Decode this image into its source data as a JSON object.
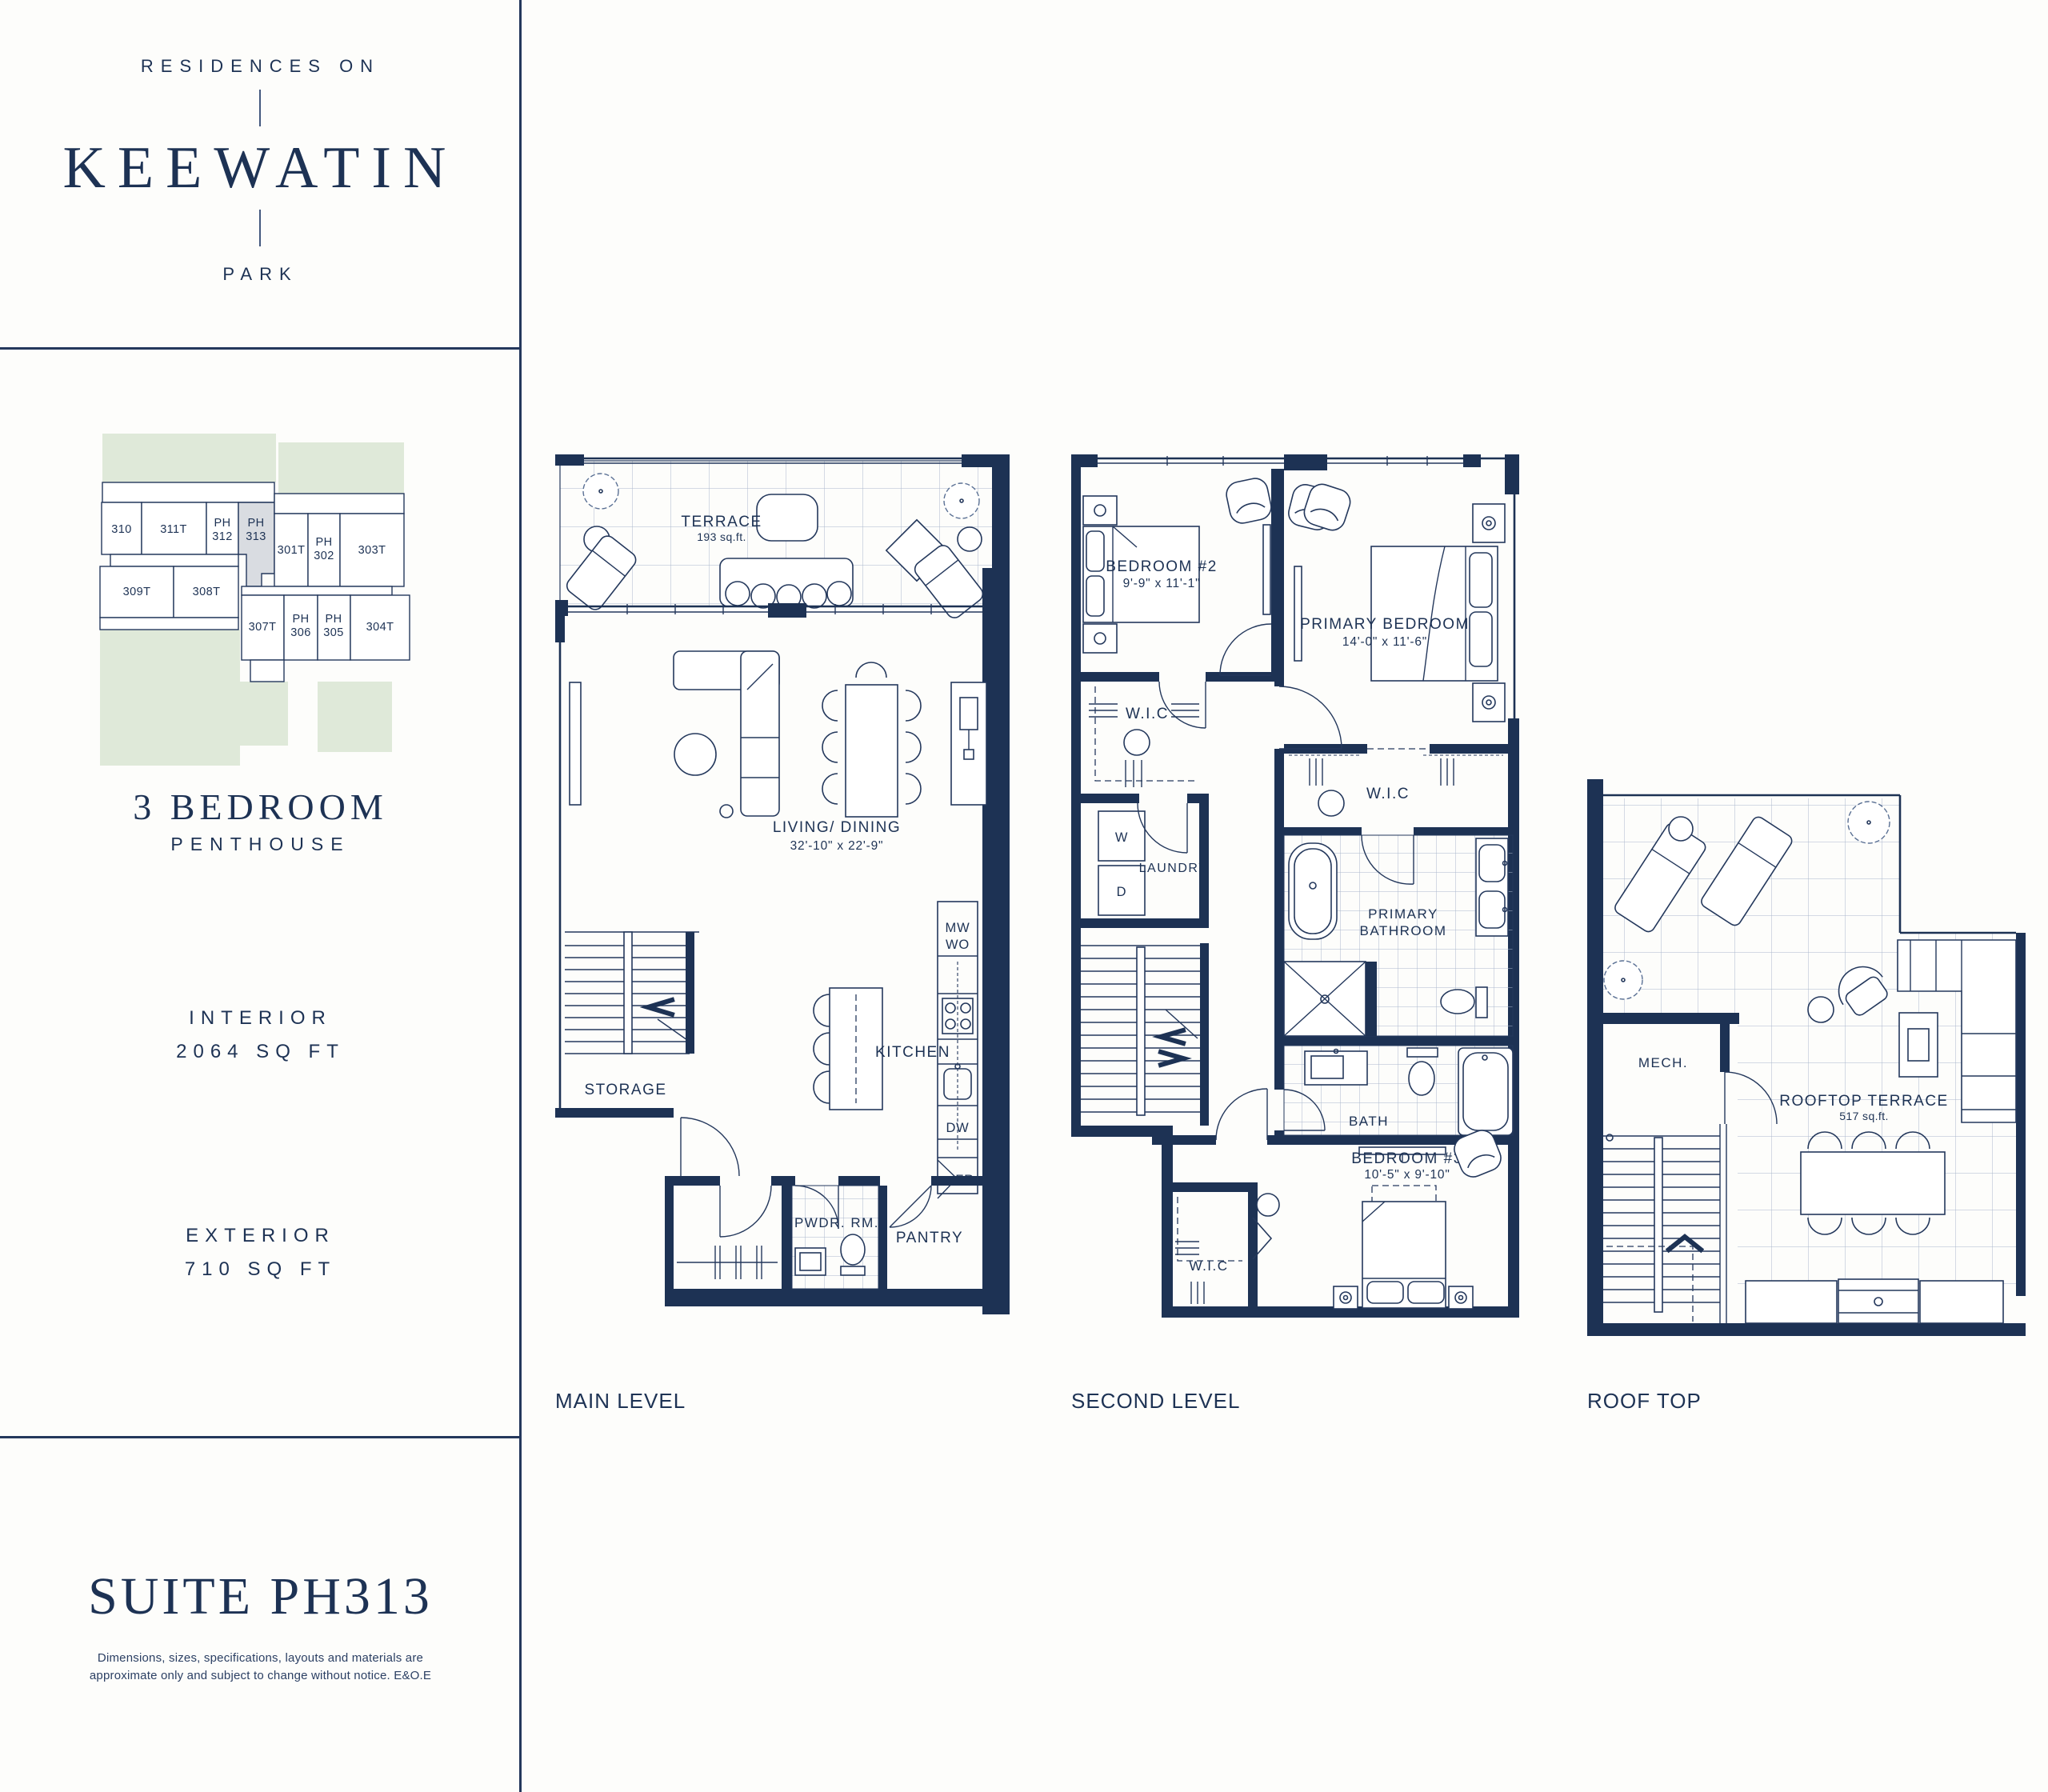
{
  "brand": {
    "line1": "RESIDENCES ON",
    "name": "KEEWATIN",
    "line2": "PARK"
  },
  "suite_info": {
    "type": "3 BEDROOM",
    "subtype": "PENTHOUSE",
    "interior_label": "INTERIOR",
    "interior_value": "2064 SQ FT",
    "exterior_label": "EXTERIOR",
    "exterior_value": "710 SQ FT"
  },
  "suite_title": "SUITE PH313",
  "disclaimer": {
    "line1": "Dimensions, sizes, specifications, layouts and materials are",
    "line2": "approximate only and subject to change without notice. E&O.E"
  },
  "key_plan": {
    "highlighted_unit": "PH 313",
    "units": {
      "u310": "310",
      "u311t": "311T",
      "ph312_l1": "PH",
      "ph312_l2": "312",
      "ph313_l1": "PH",
      "ph313_l2": "313",
      "u301t": "301T",
      "ph302_l1": "PH",
      "ph302_l2": "302",
      "u303t": "303T",
      "u309t": "309T",
      "u308t": "308T",
      "u307t": "307T",
      "ph306_l1": "PH",
      "ph306_l2": "306",
      "ph305_l1": "PH",
      "ph305_l2": "305",
      "u304t": "304T"
    }
  },
  "main_level": {
    "name": "MAIN LEVEL",
    "terrace_label": "TERRACE",
    "terrace_area": "193 sq.ft.",
    "living_label": "LIVING/ DINING",
    "living_dim": "32'-10\" x 22'-9\"",
    "kitchen_label": "KITCHEN",
    "storage_label": "STORAGE",
    "powder_label": "PWDR. RM.",
    "pantry_label": "PANTRY",
    "appl_mw": "MW",
    "appl_wo": "WO",
    "appl_dw": "DW",
    "appl_fr": "FR"
  },
  "second_level": {
    "name": "SECOND LEVEL",
    "bedroom2_label": "BEDROOM #2",
    "bedroom2_dim": "9'-9\" x 11'-1\"",
    "primary_label": "PRIMARY BEDROOM",
    "primary_dim": "14'-0\" x 11'-6\"",
    "wic1_label": "W.I.C",
    "wic2_label": "W.I.C",
    "wic3_label": "W.I.C",
    "laundry_label": "LAUNDRY",
    "washer": "W",
    "dryer": "D",
    "pbath_l1": "PRIMARY",
    "pbath_l2": "BATHROOM",
    "bath_label": "BATH",
    "bedroom3_label": "BEDROOM #3",
    "bedroom3_dim": "10'-5\" x 9'-10\"",
    "skylight_label": "SKYLIGHT"
  },
  "roof_top": {
    "name": "ROOF TOP",
    "mech_label": "MECH.",
    "terrace_label": "ROOFTOP TERRACE",
    "terrace_area": "517 sq.ft."
  }
}
